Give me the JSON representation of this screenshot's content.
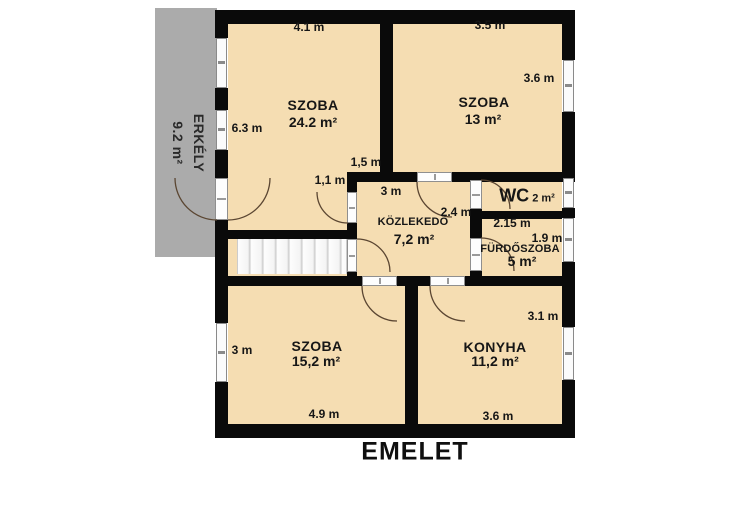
{
  "title": "EMELET",
  "colors": {
    "room_fill": "#f5ddb2",
    "balcony_fill": "#ababab",
    "wall": "#0a0a0a",
    "door_arc": "#5b4632"
  },
  "balcony": {
    "name": "ERKÉLY",
    "area": "9.2 m²"
  },
  "rooms": {
    "szoba_nagy": {
      "name": "SZOBA",
      "area": "24.2 m²",
      "dim_top": "4.1 m",
      "dim_left": "6.3 m",
      "dim_wall": "1,5 m",
      "dim_door": "1,1 m"
    },
    "szoba_kis": {
      "name": "SZOBA",
      "area": "13 m²",
      "dim_top": "3.5 m",
      "dim_right": "3.6 m"
    },
    "kozlekedo": {
      "name": "KÖZLEKEDŐ",
      "area": "7,2 m²",
      "dim_top": "3 m",
      "dim_right": "2.4 m"
    },
    "wc": {
      "name": "WC",
      "area": "2 m²"
    },
    "furdoszoba": {
      "name": "FÜRDŐSZOBA",
      "area": "5 m²",
      "dim_top": "2.15 m",
      "dim_right": "1.9 m"
    },
    "szoba_also": {
      "name": "SZOBA",
      "area": "15,2 m²",
      "dim_left": "3 m",
      "dim_bottom": "4.9 m"
    },
    "konyha": {
      "name": "KONYHA",
      "area": "11,2 m²",
      "dim_right": "3.1 m",
      "dim_bottom": "3.6 m"
    }
  }
}
